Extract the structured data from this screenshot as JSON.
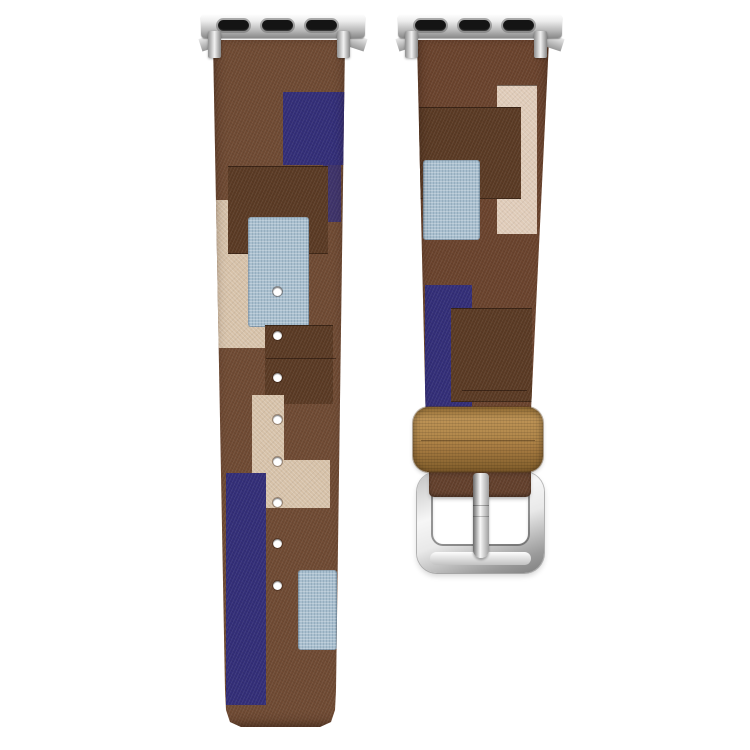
{
  "product": {
    "description": "Two-piece patchwork fabric watch strap in brown, navy, light blue and cream, with polished silver watch-case adapters, eight adjustment holes, a tan leather keeper loop and a polished silver pin buckle on a white background",
    "background": "#ffffff",
    "palette": {
      "background": "#ffffff",
      "base-brown-left": "#6F4A33",
      "base-brown-right": "#6A432D",
      "dark-brown": "#5A3A24",
      "navy": "#332E78",
      "light-blue": "#A9BFCF",
      "cream": "#D6C1A8",
      "blush-cream": "#DFCBB8",
      "keeper-tan": "#A87C42",
      "keeper-tan-light": "#BD9356",
      "keeper-tan-dark": "#8A6530",
      "silver-dark": "#8A8A8A",
      "slot-black": "#141414"
    },
    "left_strap": {
      "role": "tail strap with adjustment holes",
      "hole_count": 8,
      "patches": [
        {
          "name": "navy patch upper right",
          "color": "#332E78"
        },
        {
          "name": "navy strip right edge",
          "color": "#332E78"
        },
        {
          "name": "cream patch left",
          "color": "#D6C1A8"
        },
        {
          "name": "dark brown patch middle",
          "color": "#5A3A24"
        },
        {
          "name": "light blue burlap patch center",
          "color": "#A9BFCF"
        },
        {
          "name": "dark brown patch lower right",
          "color": "#5A3A24"
        },
        {
          "name": "cream L patch around holes",
          "color": "#D6C1A8"
        },
        {
          "name": "navy stripe bottom left",
          "color": "#332E78"
        },
        {
          "name": "light blue burlap patch bottom right",
          "color": "#A9BFCF"
        }
      ]
    },
    "right_strap": {
      "role": "buckle strap",
      "patches": [
        {
          "name": "blush cream strip right",
          "color": "#DFCBB8"
        },
        {
          "name": "dark brown patch upper",
          "color": "#5A3A24"
        },
        {
          "name": "light blue burlap patch left",
          "color": "#A9BFCF"
        },
        {
          "name": "navy stripe left",
          "color": "#332E78"
        },
        {
          "name": "dark brown patch center",
          "color": "#5A3A24"
        }
      ],
      "keeper": {
        "material": "tan leather loop",
        "color": "#A87C42"
      },
      "buckle": {
        "finish": "polished silver",
        "prong": true
      }
    },
    "hardware": {
      "adapters": 2,
      "adapter_slots_each": 3,
      "finish": "polished silver"
    }
  }
}
